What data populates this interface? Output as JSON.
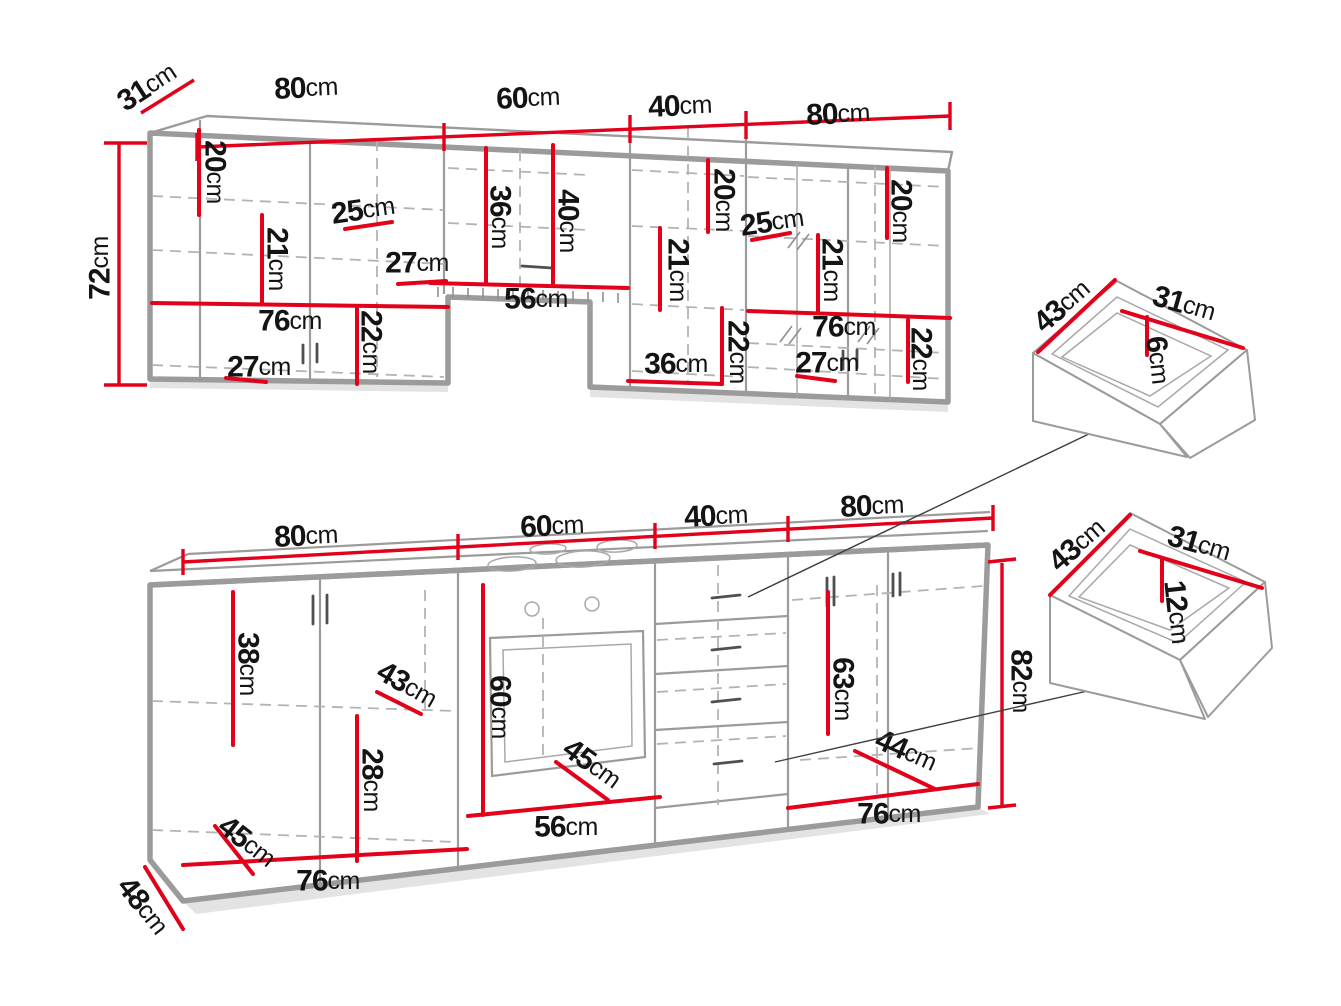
{
  "unit": "cm",
  "colors": {
    "dimension_red": "#e2001a",
    "outline_gray": "#9b9b9b",
    "hidden_line_gray": "#b3b3b3",
    "label_black": "#141414",
    "connector_gray": "#3e3e3e"
  },
  "upper_run": {
    "widths": [
      "80",
      "60",
      "40",
      "80"
    ],
    "depth": "31",
    "height": "72",
    "sec1": {
      "top_offset": "20",
      "door": "21",
      "shelf_depth": "25",
      "hood_gap": "27",
      "inner_width": "76",
      "bottom_door": "22",
      "base_depth": "27"
    },
    "hood": {
      "front": "36",
      "total": "40",
      "opening": "56"
    },
    "sec3": {
      "top_offset": "20",
      "door": "21",
      "bottom_door": "22",
      "bottom_width": "36"
    },
    "sec4": {
      "shelf_depth": "25",
      "door": "21",
      "top_offset": "20",
      "inner_width": "76",
      "base_depth": "27",
      "bottom_door": "22"
    }
  },
  "lower_run": {
    "widths": [
      "80",
      "60",
      "40",
      "80"
    ],
    "height": "82",
    "plinth_depth": "48",
    "sec1": {
      "door_top": "38",
      "shelf_depth": "43",
      "door_bottom": "28",
      "base_depth": "45",
      "inner_width": "76"
    },
    "oven": {
      "height": "60",
      "depth": "45",
      "opening": "56"
    },
    "sec4": {
      "door": "63",
      "shelf_depth": "44",
      "inner_width": "76"
    }
  },
  "drawer_small": {
    "depth": "43",
    "width": "31",
    "inner_height": "6"
  },
  "drawer_large": {
    "depth": "43",
    "width": "31",
    "inner_height": "12"
  }
}
